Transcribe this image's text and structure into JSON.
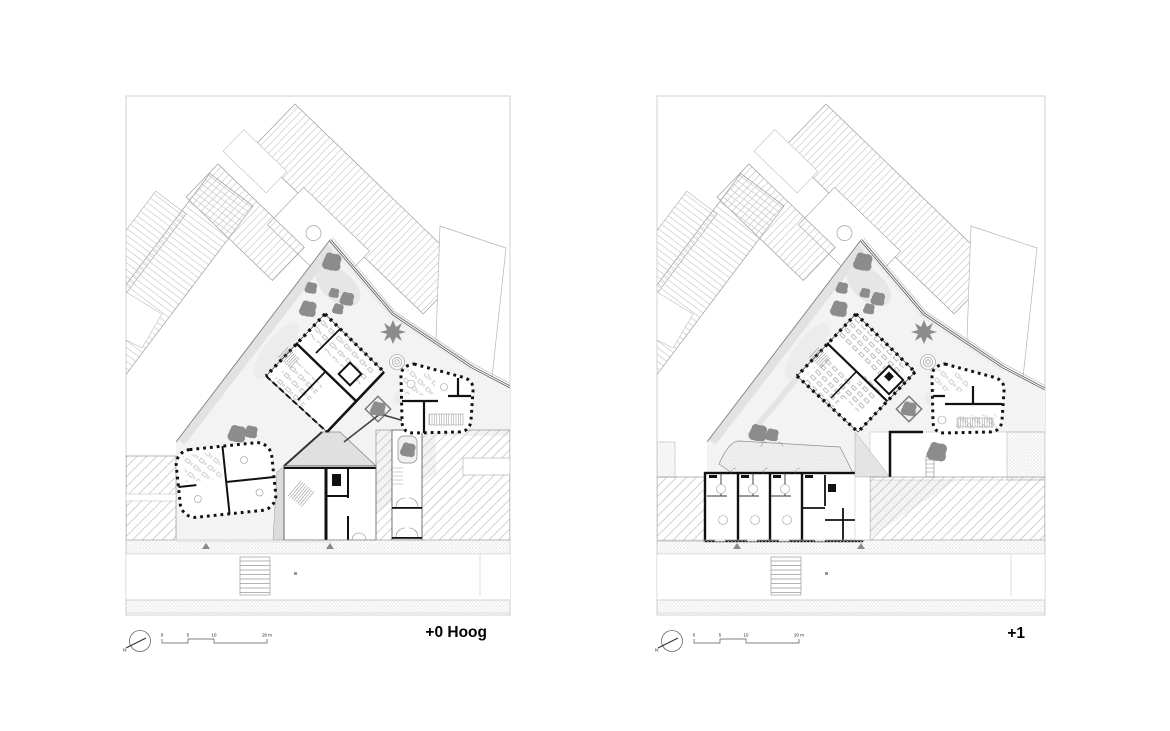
{
  "sheet": {
    "background": "#ffffff",
    "type": "architectural floor plans"
  },
  "panels": [
    {
      "name": "ground-floor-plan",
      "label": "+0 Hoog",
      "north_label": "N",
      "scale_bar": {
        "t0": "0",
        "t1": "5",
        "t2": "10",
        "t3": "20 m"
      }
    },
    {
      "name": "first-floor-plan",
      "label": "+1",
      "north_label": "N",
      "scale_bar": {
        "t0": "0",
        "t1": "5",
        "t2": "10",
        "t3": "20 m"
      }
    }
  ],
  "colors": {
    "wall": "#111111",
    "tree": "#8c8c8c",
    "site_fill": "#f3f3f3",
    "hatch_line": "#b5b5b5",
    "boundary": "#555555"
  }
}
